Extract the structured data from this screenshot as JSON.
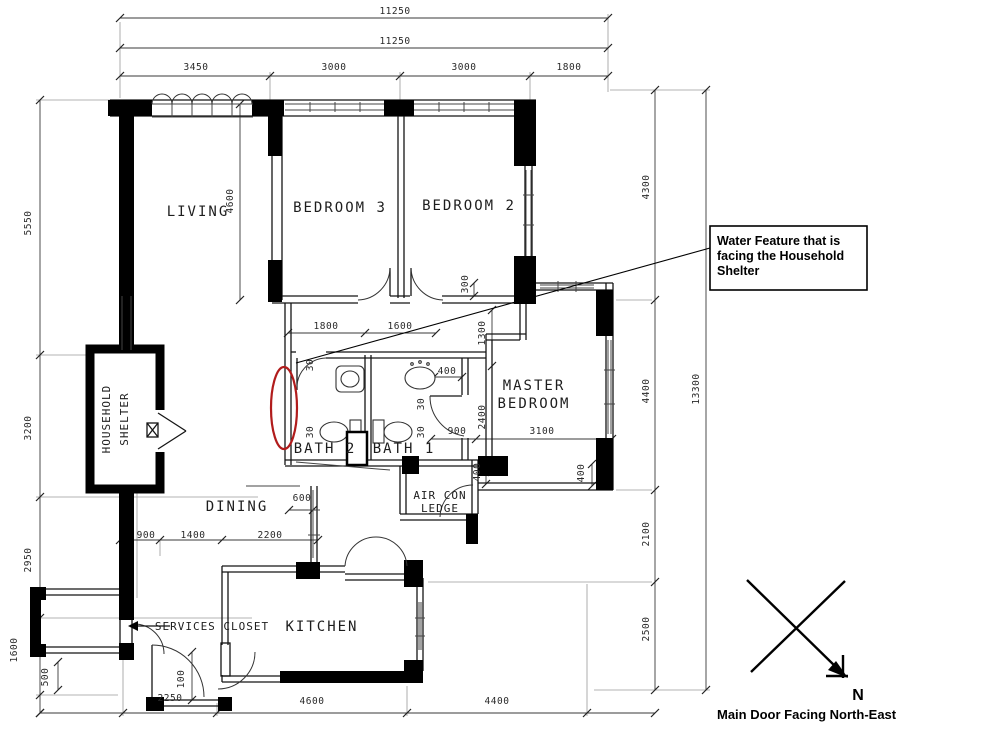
{
  "rooms": {
    "living": "LIVING",
    "bedroom3": "BEDROOM 3",
    "bedroom2": "BEDROOM 2",
    "master_line1": "MASTER",
    "master_line2": "BEDROOM",
    "bath2": "BATH 2",
    "bath1": "BATH 1",
    "dining": "DINING",
    "kitchen": "KITCHEN",
    "household_line1": "HOUSEHOLD",
    "household_line2": "SHELTER",
    "services_closet": "SERVICES CLOSET",
    "aircon_line1": "AIR CON",
    "aircon_line2": "LEDGE"
  },
  "annotation": {
    "line1": "Water Feature that is",
    "line2": "facing the Household",
    "line3": "Shelter"
  },
  "compass": {
    "north_label": "N",
    "caption": "Main Door Facing North-East"
  },
  "colors": {
    "highlight": "#b11c1c",
    "wall": "#000000",
    "dimension_text": "#2a2a2a"
  },
  "dimensions": [
    {
      "text": "11250",
      "x": 395,
      "y": 14,
      "rot": 0
    },
    {
      "text": "11250",
      "x": 395,
      "y": 44,
      "rot": 0
    },
    {
      "text": "3450",
      "x": 196,
      "y": 70,
      "rot": 0
    },
    {
      "text": "3000",
      "x": 334,
      "y": 70,
      "rot": 0
    },
    {
      "text": "3000",
      "x": 464,
      "y": 70,
      "rot": 0
    },
    {
      "text": "1800",
      "x": 569,
      "y": 70,
      "rot": 0
    },
    {
      "text": "5550",
      "x": 31,
      "y": 223,
      "rot": -90
    },
    {
      "text": "3200",
      "x": 31,
      "y": 428,
      "rot": -90
    },
    {
      "text": "2950",
      "x": 31,
      "y": 560,
      "rot": -90
    },
    {
      "text": "1600",
      "x": 17,
      "y": 650,
      "rot": -90
    },
    {
      "text": "500",
      "x": 48,
      "y": 677,
      "rot": -90
    },
    {
      "text": "4300",
      "x": 649,
      "y": 187,
      "rot": -90
    },
    {
      "text": "4400",
      "x": 649,
      "y": 391,
      "rot": -90
    },
    {
      "text": "2100",
      "x": 649,
      "y": 534,
      "rot": -90
    },
    {
      "text": "2500",
      "x": 649,
      "y": 629,
      "rot": -90
    },
    {
      "text": "13300",
      "x": 699,
      "y": 389,
      "rot": -90
    },
    {
      "text": "2250",
      "x": 170,
      "y": 701,
      "rot": 0
    },
    {
      "text": "4600",
      "x": 312,
      "y": 704,
      "rot": 0
    },
    {
      "text": "4400",
      "x": 497,
      "y": 704,
      "rot": 0
    },
    {
      "text": "4600",
      "x": 233,
      "y": 201,
      "rot": -90
    },
    {
      "text": "1800",
      "x": 326,
      "y": 329,
      "rot": 0
    },
    {
      "text": "1600",
      "x": 400,
      "y": 329,
      "rot": 0
    },
    {
      "text": "300",
      "x": 468,
      "y": 284,
      "rot": -90
    },
    {
      "text": "1300",
      "x": 485,
      "y": 333,
      "rot": -90
    },
    {
      "text": "400",
      "x": 447,
      "y": 374,
      "rot": 0
    },
    {
      "text": "2400",
      "x": 485,
      "y": 417,
      "rot": -90
    },
    {
      "text": "900",
      "x": 457,
      "y": 434,
      "rot": 0
    },
    {
      "text": "3100",
      "x": 542,
      "y": 434,
      "rot": 0
    },
    {
      "text": "400",
      "x": 480,
      "y": 472,
      "rot": -90
    },
    {
      "text": "400",
      "x": 584,
      "y": 473,
      "rot": -90
    },
    {
      "text": "600",
      "x": 302,
      "y": 501,
      "rot": 0
    },
    {
      "text": "900",
      "x": 146,
      "y": 538,
      "rot": 0
    },
    {
      "text": "1400",
      "x": 193,
      "y": 538,
      "rot": 0
    },
    {
      "text": "2200",
      "x": 270,
      "y": 538,
      "rot": 0
    },
    {
      "text": "100",
      "x": 184,
      "y": 679,
      "rot": -90
    },
    {
      "text": "30",
      "x": 313,
      "y": 365,
      "rot": -90
    },
    {
      "text": "30",
      "x": 424,
      "y": 404,
      "rot": -90
    },
    {
      "text": "30",
      "x": 313,
      "y": 432,
      "rot": -90
    },
    {
      "text": "30",
      "x": 424,
      "y": 432,
      "rot": -90
    }
  ]
}
